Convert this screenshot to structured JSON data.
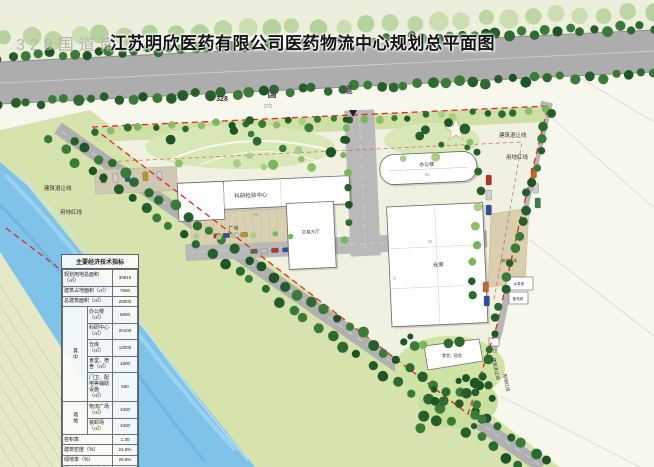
{
  "title": {
    "watermark": "328国道南侧办",
    "main": "江苏明欣医药有限公司医药物流中心规划总平面图"
  },
  "road": {
    "number": "328",
    "name_char1": "国",
    "name_char2": "道",
    "dim": "270"
  },
  "lines": {
    "setback": "建筑退让线",
    "redline": "用地红线"
  },
  "buildings": {
    "research": "科研检验中心",
    "trade_hall": "交易大厅",
    "office": "办公楼",
    "warehouse": "仓库",
    "canteen_dorm": "食堂、宿舍",
    "plaza": "广场",
    "logistics_plaza": "物流广场",
    "pump_house": "水泵房",
    "power_house": "配电房",
    "gate": "门卫"
  },
  "dims": {
    "research_len": "93",
    "office_len": "60",
    "warehouse_w": "55",
    "warehouse_h": "72"
  },
  "table": {
    "title": "主要经济技术指标",
    "group_mid": "其中",
    "group_site": "场地",
    "rows": [
      {
        "label": "规划用地总面积（㎡）",
        "value": "30815"
      },
      {
        "label": "建筑占地面积（㎡）",
        "value": "7600"
      },
      {
        "label": "总建筑面积（㎡）",
        "value": "29000"
      },
      {
        "label": "办公楼（㎡）",
        "value": "5500"
      },
      {
        "label": "科研中心（㎡）",
        "value": "20100"
      },
      {
        "label": "仓库（㎡）",
        "value": "12000"
      },
      {
        "label": "食堂、宿舍（㎡）",
        "value": "1800"
      },
      {
        "label": "门卫、配电等辅助设施（㎡）",
        "value": "500"
      },
      {
        "label": "物流广场（㎡）",
        "value": "1000"
      },
      {
        "label": "装卸场（㎡）",
        "value": "1000"
      },
      {
        "label": "容积率",
        "value": "1.30"
      },
      {
        "label": "建筑密度（%）",
        "value": "24.8%"
      },
      {
        "label": "绿地率（%）",
        "value": "28.8%"
      },
      {
        "label": "机动车停车位（辆）",
        "value": "130"
      }
    ]
  },
  "colors": {
    "redline": "#e8251f",
    "water": "#7fc4e8",
    "road": "#aeaeae",
    "lawn": "#d6e3ad",
    "tree": "#2d6a32"
  }
}
